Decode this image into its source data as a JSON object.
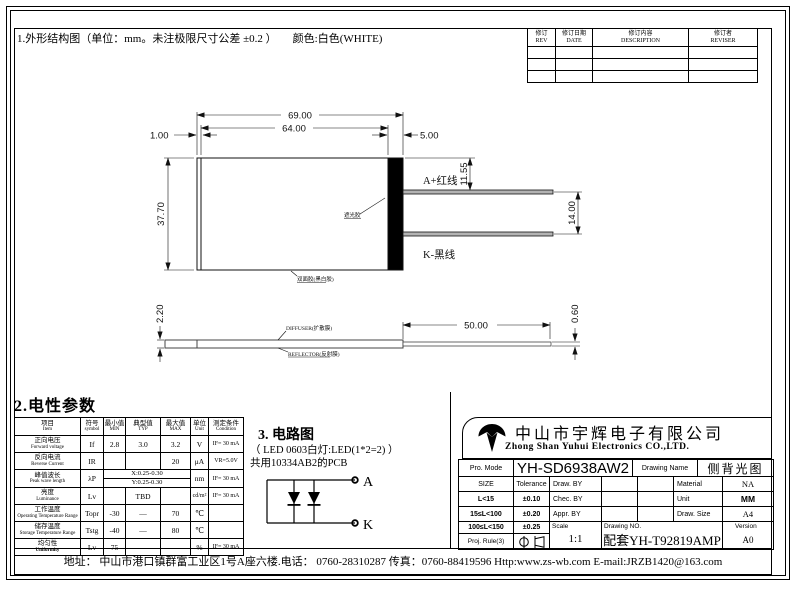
{
  "top_note": {
    "text": "1.外形结构图（单位：mm。未注极限尺寸公差 ±0.2 ）",
    "color_note": "颜色:白色(WHITE)"
  },
  "revision_table": {
    "headers": [
      {
        "cn": "修订",
        "en": "REV"
      },
      {
        "cn": "修订日期",
        "en": "DATE"
      },
      {
        "cn": "修订内容",
        "en": "DESCRIPTION"
      },
      {
        "cn": "修订者",
        "en": "REVISER"
      }
    ]
  },
  "outline": {
    "dims": {
      "total_width": "69.00",
      "body_width": "64.00",
      "left_edge": "1.00",
      "bar_width": "5.00",
      "height": "37.70",
      "wire_a_offset": "11.55",
      "wire_spacing": "14.00",
      "wire_length": "50.00",
      "thickness": "2.20",
      "tail_thickness": "0.60"
    },
    "labels": {
      "wire_a": "A+红线",
      "wire_k": "K-黑线",
      "shading_tape": "遮光胶",
      "bottom_tape": "双面胶(黑白胶)",
      "diffuser": "DIFFUSER(扩散膜)",
      "reflector": "REFLECTOR(反射膜)"
    }
  },
  "electrical": {
    "section_title": "2.电性参数",
    "headers": {
      "item_cn": "项目",
      "item_en": "Item",
      "sym_cn": "符号",
      "sym_en": "symbol",
      "min_cn": "最小值",
      "min_en": "MIN",
      "typ_cn": "典型值",
      "typ_en": "TYP",
      "max_cn": "最大值",
      "max_en": "MAX",
      "unit_cn": "单位",
      "unit_en": "Unit",
      "cond_cn": "测定条件",
      "cond_en": "Condition"
    },
    "rows": [
      {
        "cn": "正向电压",
        "en": "Forward voltage",
        "sym": "If",
        "min": "2.8",
        "typ": "3.0",
        "max": "3.2",
        "unit": "V",
        "cond": "IF= 30 mA"
      },
      {
        "cn": "反向电流",
        "en": "Reverse Current",
        "sym": "IR",
        "min": "",
        "typ": "",
        "max": "20",
        "unit": "μA",
        "cond": "VR=5.0V"
      },
      {
        "cn": "峰值波长",
        "en": "Peak wave length",
        "sym": "λP",
        "row_x": "X:0.25-0.30",
        "row_y": "Y:0.25-0.30",
        "unit": "nm",
        "cond": "IF= 30 mA"
      },
      {
        "cn": "亮度",
        "en": "Luminance",
        "sym": "Lv",
        "min": "",
        "typ": "TBD",
        "max": "",
        "unit": "cd/m²",
        "cond": "IF= 30 mA"
      },
      {
        "cn": "工作温度",
        "en": "Operating Temperature Range",
        "sym": "Topr",
        "min": "-30",
        "typ": "—",
        "max": "70",
        "unit": "℃",
        "cond": ""
      },
      {
        "cn": "储存温度",
        "en": "Storage Temperature Range",
        "sym": "Tstg",
        "min": "-40",
        "typ": "—",
        "max": "80",
        "unit": "℃",
        "cond": ""
      },
      {
        "cn": "均匀性",
        "en": "Uniformity",
        "sym": "Lv",
        "min": "75",
        "typ": "",
        "max": "",
        "unit": "%",
        "cond": "IF= 30 mA"
      }
    ]
  },
  "circuit": {
    "section_title": "3. 电路图",
    "subtitle1": "（ LED 0603白灯:LED(1*2=2) ）",
    "subtitle2": "共用10334AB2的PCB",
    "anode": "A",
    "cathode": "K"
  },
  "title_block": {
    "company_cn": "中山市宇辉电子有限公司",
    "company_en": "Zhong Shan Yuhui Electronics CO.,LTD.",
    "pro_mode_label": "Pro. Mode",
    "pro_mode": "YH-SD6938AW2",
    "drawing_name_label": "Drawing Name",
    "drawing_name": "侧背光图",
    "size_label": "SIZE",
    "tolerance_label": "Tolerance",
    "rows": [
      {
        "size": "L<15",
        "tol": "±0.10"
      },
      {
        "size": "15≤L<100",
        "tol": "±0.20"
      },
      {
        "size": "100≤L<150",
        "tol": "±0.25"
      }
    ],
    "proj_rule_label": "Proj. Rule(3)",
    "draw_by_label": "Draw. BY",
    "chec_by_label": "Chec. BY",
    "appr_by_label": "Appr. BY",
    "material_label": "Material",
    "material": "NA",
    "unit_label": "Unit",
    "unit": "MM",
    "draw_size_label": "Draw. Size",
    "draw_size": "A4",
    "scale_label": "Scale",
    "scale": "1:1",
    "drawing_no_label": "Drawing NO.",
    "drawing_no": "配套YH-T92819AMP",
    "version_label": "Version",
    "version": "A0"
  },
  "footer": {
    "address": "地址： 中山市港口镇群富工业区1号A座六楼.电话： 0760-28310287 传真：0760-88419596 Http:www.zs-wb.com  E-mail:JRZB1420@163.com"
  }
}
